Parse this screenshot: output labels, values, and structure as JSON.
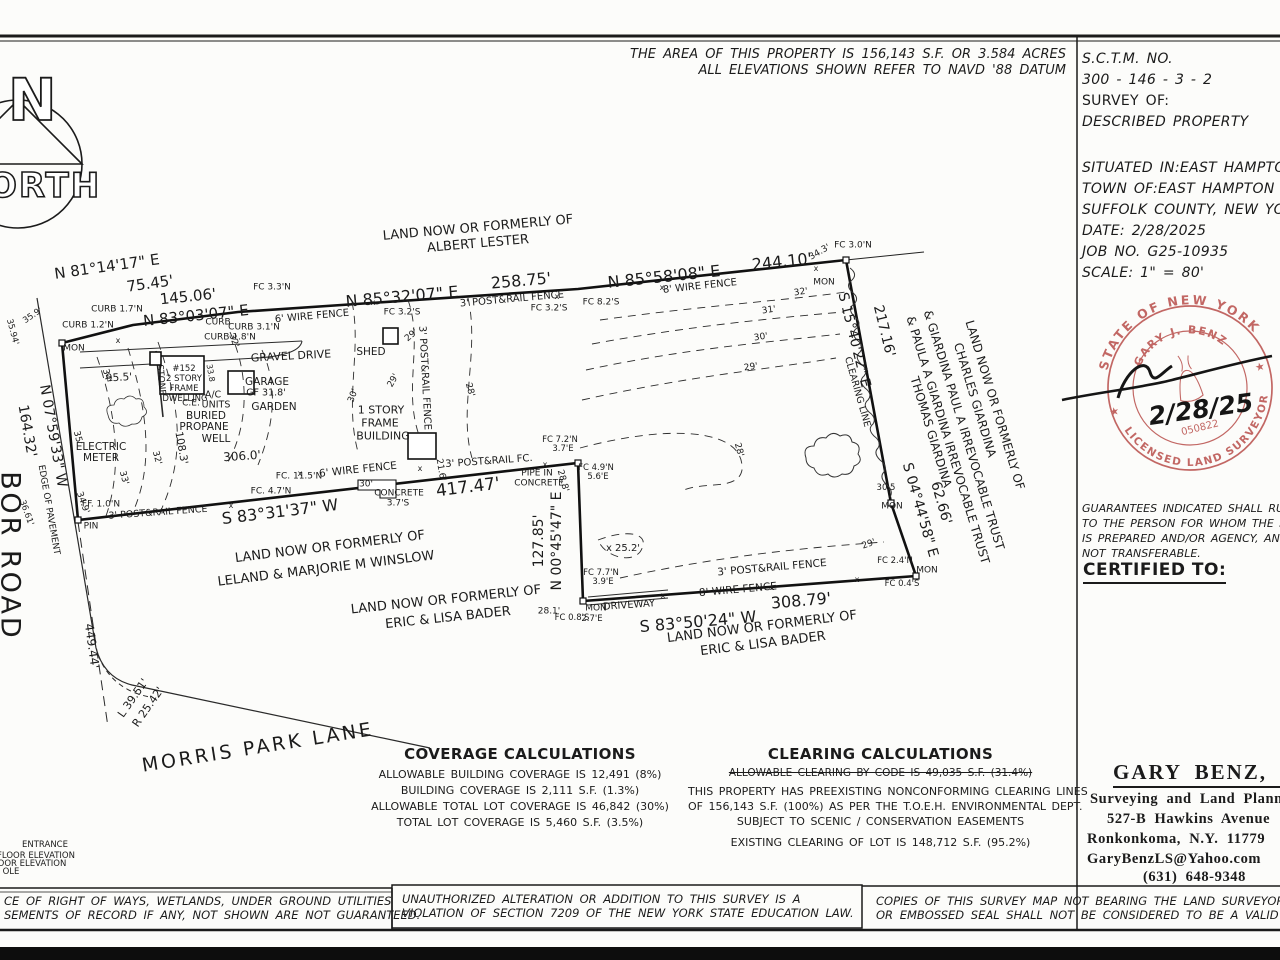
{
  "notes_top": [
    "THE AREA OF THIS PROPERTY IS 156,143 S.F. OR 3.584 ACRES",
    "ALL ELEVATIONS SHOWN REFER TO NAVD '88 DATUM"
  ],
  "north": {
    "n": "N",
    "orth": "ORTH"
  },
  "title_block": {
    "sctm_label": "S.C.T.M. NO.",
    "sctm_value": "300   -   146   -   3   -   2",
    "survey_of_label": "SURVEY OF:",
    "survey_of_value": "DESCRIBED PROPERTY",
    "situated_in": "SITUATED IN:EAST HAMPTON",
    "town_of": "TOWN OF:EAST HAMPTON",
    "county": "SUFFOLK COUNTY, NEW YORK",
    "date": "DATE: 2/28/2025",
    "job_no": "JOB NO. G25-10935",
    "scale": "SCALE: 1\" = 80'"
  },
  "stamp": {
    "arc_top": "STATE OF NEW YORK",
    "name": "GARY J. BENZ",
    "arc_bottom": "LICENSED LAND SURVEYOR",
    "license_no": "050822",
    "date_signed": "2/28/25",
    "color": "#b84e4a"
  },
  "guarantees": [
    "GUARANTEES INDICATED SHALL RUN ONLY",
    "TO THE PERSON FOR WHOM THE SURVEY",
    "IS PREPARED AND/OR AGENCY, AND IS",
    "NOT TRANSFERABLE."
  ],
  "certified_to": "CERTIFIED TO:",
  "surveyor": {
    "name": "GARY BENZ, L.S.",
    "line1": "Surveying and Land Planning",
    "line2": "527-B Hawkins Avenue",
    "line3": "Ronkonkoma, N.Y. 11779",
    "line4": "GaryBenzLS@Yahoo.com",
    "line5": "(631) 648-9348"
  },
  "coverage": {
    "title": "COVERAGE CALCULATIONS",
    "lines": [
      "ALLOWABLE BUILDING COVERAGE IS 12,491 (8%)",
      "BUILDING COVERAGE IS 2,111 S.F. (1.3%)",
      "ALLOWABLE TOTAL LOT COVERAGE IS 46,842 (30%)",
      "TOTAL LOT COVERAGE IS 5,460 S.F. (3.5%)"
    ]
  },
  "clearing": {
    "title": "CLEARING CALCULATIONS",
    "struck": "ALLOWABLE CLEARING BY CODE IS 49,035 S.F. (31.4%)",
    "lines": [
      "THIS PROPERTY HAS PREEXISTING NONCONFORMING CLEARING LINES",
      "OF 156,143 S.F. (100%) AS PER THE T.O.E.H. ENVIRONMENTAL DEPT.",
      "SUBJECT TO SCENIC / CONSERVATION EASEMENTS"
    ],
    "existing": "EXISTING CLEARING OF LOT IS 148,712 S.F. (95.2%)"
  },
  "boxes": {
    "left": [
      "CE OF RIGHT OF WAYS, WETLANDS, UNDER GROUND UTILITIES",
      "SEMENTS OF RECORD IF ANY, NOT SHOWN ARE NOT GUARANTEED."
    ],
    "middle": [
      "UNAUTHORIZED ALTERATION OR ADDITION TO THIS SURVEY IS A",
      "VIOLATION OF SECTION 7209 OF THE NEW YORK STATE EDUCATION LAW."
    ],
    "right": [
      "COPIES OF THIS SURVEY MAP NOT BEARING THE LAND SURVEYOR'S INKED SEAL",
      "OR EMBOSSED SEAL SHALL NOT BE CONSIDERED TO BE A VALID TRUE COPY."
    ]
  },
  "map_labels": [
    {
      "t": "N 81°14'17\" E",
      "x": 107,
      "y": 267,
      "r": -8,
      "s": 15
    },
    {
      "t": "75.45'",
      "x": 150,
      "y": 284,
      "r": -8,
      "s": 15
    },
    {
      "t": "145.06'",
      "x": 188,
      "y": 297,
      "r": -6,
      "s": 15
    },
    {
      "t": "N 83°03'07\" E",
      "x": 196,
      "y": 316,
      "r": -6,
      "s": 15
    },
    {
      "t": "N 85°32'07\" E",
      "x": 402,
      "y": 297,
      "r": -5,
      "s": 16
    },
    {
      "t": "258.75'",
      "x": 521,
      "y": 281,
      "r": -5,
      "s": 16
    },
    {
      "t": "N 85°58'08\" E",
      "x": 664,
      "y": 277,
      "r": -6,
      "s": 16
    },
    {
      "t": "244.10'",
      "x": 782,
      "y": 262,
      "r": -6,
      "s": 16
    },
    {
      "t": "S 15°40'22\" E",
      "x": 854,
      "y": 340,
      "r": 76,
      "s": 14
    },
    {
      "t": "217.16'",
      "x": 884,
      "y": 331,
      "r": 76,
      "s": 14
    },
    {
      "t": "S 04°44'58\" E",
      "x": 920,
      "y": 510,
      "r": 74,
      "s": 14
    },
    {
      "t": "62.66'",
      "x": 941,
      "y": 503,
      "r": 74,
      "s": 14
    },
    {
      "t": "S 83°31'37\" W",
      "x": 280,
      "y": 512,
      "r": -7,
      "s": 16
    },
    {
      "t": "417.47'",
      "x": 468,
      "y": 488,
      "r": -7,
      "s": 17
    },
    {
      "t": "N 00°45'47\" E",
      "x": 557,
      "y": 541,
      "r": -90,
      "s": 14
    },
    {
      "t": "127.85'",
      "x": 539,
      "y": 541,
      "r": -90,
      "s": 14
    },
    {
      "t": "S 83°50'24\" W",
      "x": 698,
      "y": 622,
      "r": -5,
      "s": 16
    },
    {
      "t": "308.79'",
      "x": 801,
      "y": 601,
      "r": -5,
      "s": 16
    },
    {
      "t": "N 07°59'33\" W",
      "x": 53,
      "y": 436,
      "r": 80,
      "s": 14
    },
    {
      "t": "164.32'",
      "x": 27,
      "y": 431,
      "r": 80,
      "s": 14
    },
    {
      "t": "449.44'",
      "x": 92,
      "y": 646,
      "r": 82,
      "s": 12
    },
    {
      "t": "L 39.51'",
      "x": 133,
      "y": 698,
      "r": -55,
      "s": 11
    },
    {
      "t": "R 25.42'",
      "x": 148,
      "y": 707,
      "r": -55,
      "s": 11
    },
    {
      "t": "LAND NOW OR FORMERLY OF",
      "x": 478,
      "y": 228,
      "r": -5,
      "s": 13
    },
    {
      "t": "ALBERT LESTER",
      "x": 478,
      "y": 244,
      "r": -5,
      "s": 13
    },
    {
      "t": "LAND NOW OR FORMERLY OF",
      "x": 330,
      "y": 547,
      "r": -7,
      "s": 13
    },
    {
      "t": "LELAND & MARJORIE M WINSLOW",
      "x": 326,
      "y": 569,
      "r": -7,
      "s": 13
    },
    {
      "t": "LAND NOW OR FORMERLY OF",
      "x": 446,
      "y": 600,
      "r": -6,
      "s": 13
    },
    {
      "t": "ERIC & LISA BADER",
      "x": 448,
      "y": 618,
      "r": -6,
      "s": 13
    },
    {
      "t": "LAND NOW OR FORMERLY OF",
      "x": 762,
      "y": 627,
      "r": -7,
      "s": 13
    },
    {
      "t": "ERIC & LISA BADER",
      "x": 763,
      "y": 644,
      "r": -7,
      "s": 13
    },
    {
      "t": "LAND NOW OR FORMERLY OF",
      "x": 995,
      "y": 405,
      "r": 73,
      "s": 12
    },
    {
      "t": "CHARLES GIARDINA",
      "x": 975,
      "y": 400,
      "r": 73,
      "s": 12
    },
    {
      "t": "& GIARDINA PAUL A IRREVOCABLE TRUST",
      "x": 964,
      "y": 430,
      "r": 73,
      "s": 12
    },
    {
      "t": "& PAULA A GIARDINA IRREVOCABLE TRUST",
      "x": 948,
      "y": 440,
      "r": 73,
      "s": 12
    },
    {
      "t": "THOMAS GIARDINA",
      "x": 931,
      "y": 432,
      "r": 73,
      "s": 12
    },
    {
      "t": "BOR ROAD",
      "x": 10,
      "y": 556,
      "r": 90,
      "s": 27,
      "ls": 3,
      "n": "road-name-harbor-road"
    },
    {
      "t": "MORRIS PARK LANE",
      "x": 258,
      "y": 748,
      "r": -9,
      "s": 19,
      "ls": 3,
      "n": "road-name-morris-park-lane"
    },
    {
      "t": "EDGE OF PAVEMENT",
      "x": 48,
      "y": 510,
      "r": 80,
      "s": 9
    },
    {
      "t": "GRAVEL DRIVE",
      "x": 291,
      "y": 356,
      "r": -3,
      "s": 11
    },
    {
      "t": "MON",
      "x": 74,
      "y": 349,
      "r": 0,
      "s": 9
    },
    {
      "t": "CURB 1.2'N",
      "x": 88,
      "y": 326,
      "r": 0,
      "s": 9
    },
    {
      "t": "CURB 1.7'N",
      "x": 117,
      "y": 310,
      "r": 0,
      "s": 9
    },
    {
      "t": "CURB",
      "x": 218,
      "y": 323,
      "r": 0,
      "s": 9
    },
    {
      "t": "CURB 1.8'N",
      "x": 230,
      "y": 338,
      "r": 0,
      "s": 9
    },
    {
      "t": "CURB 3.1'N",
      "x": 254,
      "y": 328,
      "r": 0,
      "s": 9
    },
    {
      "t": "FC 3.3'N",
      "x": 272,
      "y": 288,
      "r": 0,
      "s": 9
    },
    {
      "t": "6' WIRE FENCE",
      "x": 312,
      "y": 317,
      "r": -5,
      "s": 10
    },
    {
      "t": "3' POST&RAIL FENCE",
      "x": 512,
      "y": 300,
      "r": -5,
      "s": 10
    },
    {
      "t": "FC 3.2'S",
      "x": 402,
      "y": 313,
      "r": 0,
      "s": 9
    },
    {
      "t": "FC 3.2'S",
      "x": 549,
      "y": 309,
      "r": 0,
      "s": 9
    },
    {
      "t": "FC 8.2'S",
      "x": 601,
      "y": 303,
      "r": 0,
      "s": 9
    },
    {
      "t": "8' WIRE FENCE",
      "x": 700,
      "y": 287,
      "r": -6,
      "s": 10
    },
    {
      "t": "34.3'",
      "x": 820,
      "y": 253,
      "r": -30,
      "s": 9
    },
    {
      "t": "FC 3.0'N",
      "x": 853,
      "y": 246,
      "r": 0,
      "s": 9
    },
    {
      "t": "MON",
      "x": 824,
      "y": 283,
      "r": 0,
      "s": 9
    },
    {
      "t": "SHED",
      "x": 371,
      "y": 352,
      "r": 0,
      "s": 10.5
    },
    {
      "t": "3' POST&RAIL FENCE",
      "x": 424,
      "y": 378,
      "r": 87,
      "s": 10
    },
    {
      "t": "1 STORY",
      "x": 381,
      "y": 410,
      "r": 0,
      "s": 11
    },
    {
      "t": "FRAME",
      "x": 380,
      "y": 423,
      "r": 0,
      "s": 11
    },
    {
      "t": "BUILDING",
      "x": 383,
      "y": 436,
      "r": 0,
      "s": 11
    },
    {
      "t": "#152",
      "x": 184,
      "y": 369,
      "r": 0,
      "s": 8.5
    },
    {
      "t": "2 STORY",
      "x": 184,
      "y": 379,
      "r": 0,
      "s": 8.5
    },
    {
      "t": "FRAME",
      "x": 184,
      "y": 389,
      "r": 0,
      "s": 8.5
    },
    {
      "t": "DWELLING",
      "x": 185,
      "y": 399,
      "r": 0,
      "s": 8.5
    },
    {
      "t": "STONE",
      "x": 160,
      "y": 380,
      "r": 85,
      "s": 9
    },
    {
      "t": "GARAGE",
      "x": 267,
      "y": 382,
      "r": 0,
      "s": 10.5
    },
    {
      "t": "GF 31.8'",
      "x": 266,
      "y": 393,
      "r": 0,
      "s": 9.5
    },
    {
      "t": "A/C",
      "x": 213,
      "y": 395,
      "r": 0,
      "s": 9.5
    },
    {
      "t": "UNITS",
      "x": 216,
      "y": 405,
      "r": 0,
      "s": 9.5
    },
    {
      "t": "C.E.",
      "x": 191,
      "y": 404,
      "r": 0,
      "s": 9
    },
    {
      "t": "GARDEN",
      "x": 274,
      "y": 407,
      "r": 0,
      "s": 10.5
    },
    {
      "t": "BURIED",
      "x": 206,
      "y": 416,
      "r": 0,
      "s": 10.5
    },
    {
      "t": "PROPANE",
      "x": 204,
      "y": 427,
      "r": 0,
      "s": 10.5
    },
    {
      "t": "WELL",
      "x": 216,
      "y": 439,
      "r": 0,
      "s": 10.5
    },
    {
      "t": "ELECTRIC",
      "x": 101,
      "y": 447,
      "r": 0,
      "s": 10.5
    },
    {
      "t": "METER",
      "x": 101,
      "y": 458,
      "r": 0,
      "s": 10.5
    },
    {
      "t": "95.5'",
      "x": 119,
      "y": 378,
      "r": -3,
      "s": 10.5
    },
    {
      "t": "108.3'",
      "x": 181,
      "y": 448,
      "r": 80,
      "s": 10.5
    },
    {
      "t": "306.0'",
      "x": 242,
      "y": 456,
      "r": -4,
      "s": 12
    },
    {
      "t": "6' WIRE FENCE",
      "x": 358,
      "y": 470,
      "r": -6,
      "s": 10.5
    },
    {
      "t": "FC. 11.5'N",
      "x": 299,
      "y": 477,
      "r": 0,
      "s": 9
    },
    {
      "t": "FC. 4.7'N",
      "x": 271,
      "y": 492,
      "r": 0,
      "s": 9
    },
    {
      "t": "3' POST&RAIL FC.",
      "x": 489,
      "y": 462,
      "r": -4,
      "s": 10
    },
    {
      "t": "FC 7.2'N",
      "x": 560,
      "y": 440,
      "r": 0,
      "s": 8.5
    },
    {
      "t": "3.7'E",
      "x": 563,
      "y": 449,
      "r": 0,
      "s": 8.5
    },
    {
      "t": "PIPE IN",
      "x": 537,
      "y": 474,
      "r": 0,
      "s": 9
    },
    {
      "t": "CONCRETE",
      "x": 539,
      "y": 484,
      "r": 0,
      "s": 9
    },
    {
      "t": "28.8'",
      "x": 562,
      "y": 481,
      "r": 75,
      "s": 9
    },
    {
      "t": "FC 4.9'N",
      "x": 596,
      "y": 468,
      "r": 0,
      "s": 8.5
    },
    {
      "t": "5.6'E",
      "x": 598,
      "y": 477,
      "r": 0,
      "s": 8.5
    },
    {
      "t": "CONCRETE",
      "x": 399,
      "y": 494,
      "r": 0,
      "s": 9
    },
    {
      "t": "3.7'S",
      "x": 398,
      "y": 504,
      "r": 0,
      "s": 9
    },
    {
      "t": "3' POST&RAIL FENCE",
      "x": 158,
      "y": 513,
      "r": -4,
      "s": 9.5
    },
    {
      "t": "PIN",
      "x": 91,
      "y": 527,
      "r": 0,
      "s": 9
    },
    {
      "t": "34.9'",
      "x": 82,
      "y": 503,
      "r": 70,
      "s": 9
    },
    {
      "t": "36.61'",
      "x": 26,
      "y": 513,
      "r": 70,
      "s": 8.5
    },
    {
      "t": "FF. 1.0'N",
      "x": 101,
      "y": 505,
      "r": 0,
      "s": 9
    },
    {
      "t": "x 25.2'",
      "x": 623,
      "y": 549,
      "r": 0,
      "s": 10
    },
    {
      "t": "DRIVEWAY",
      "x": 629,
      "y": 606,
      "r": -4,
      "s": 10
    },
    {
      "t": "8' WIRE FENCE",
      "x": 738,
      "y": 590,
      "r": -5,
      "s": 10.5
    },
    {
      "t": "3' POST&RAIL FENCE",
      "x": 772,
      "y": 568,
      "r": -5,
      "s": 10.5
    },
    {
      "t": "FC 7.7'N",
      "x": 601,
      "y": 573,
      "r": 0,
      "s": 8.5
    },
    {
      "t": "3.9'E",
      "x": 603,
      "y": 582,
      "r": 0,
      "s": 8.5
    },
    {
      "t": "28.1'",
      "x": 549,
      "y": 612,
      "r": 0,
      "s": 9
    },
    {
      "t": "FC 0.8'S",
      "x": 572,
      "y": 618,
      "r": 0,
      "s": 8.5
    },
    {
      "t": "MON",
      "x": 596,
      "y": 609,
      "r": 0,
      "s": 9
    },
    {
      "t": "2.7'E",
      "x": 592,
      "y": 619,
      "r": 0,
      "s": 8.5
    },
    {
      "t": "FC 2.4'N",
      "x": 895,
      "y": 561,
      "r": 0,
      "s": 8.5
    },
    {
      "t": "MON",
      "x": 927,
      "y": 571,
      "r": 0,
      "s": 9
    },
    {
      "t": "FC 0.4'S",
      "x": 902,
      "y": 584,
      "r": 0,
      "s": 8.5
    },
    {
      "t": "30.5",
      "x": 886,
      "y": 488,
      "r": 0,
      "s": 8.5
    },
    {
      "t": "MON",
      "x": 892,
      "y": 507,
      "r": 0,
      "s": 9
    },
    {
      "t": "CLEARING LINE",
      "x": 857,
      "y": 392,
      "r": 74,
      "s": 9.5
    },
    {
      "t": "35'",
      "x": 77,
      "y": 438,
      "r": 75,
      "s": 9
    },
    {
      "t": "34'",
      "x": 106,
      "y": 376,
      "r": 75,
      "s": 9
    },
    {
      "t": "33'",
      "x": 123,
      "y": 478,
      "r": 75,
      "s": 9
    },
    {
      "t": "32'",
      "x": 156,
      "y": 458,
      "r": 75,
      "s": 9
    },
    {
      "t": "32'",
      "x": 233,
      "y": 341,
      "r": 70,
      "s": 9
    },
    {
      "t": "30'",
      "x": 354,
      "y": 396,
      "r": -70,
      "s": 9
    },
    {
      "t": "29'",
      "x": 412,
      "y": 336,
      "r": -40,
      "s": 9
    },
    {
      "t": "29'",
      "x": 394,
      "y": 381,
      "r": -60,
      "s": 9
    },
    {
      "t": "28'",
      "x": 469,
      "y": 390,
      "r": 75,
      "s": 9
    },
    {
      "t": "32'",
      "x": 801,
      "y": 293,
      "r": -8,
      "s": 9
    },
    {
      "t": "31'",
      "x": 769,
      "y": 311,
      "r": -8,
      "s": 9
    },
    {
      "t": "30'",
      "x": 761,
      "y": 338,
      "r": -8,
      "s": 9
    },
    {
      "t": "29'",
      "x": 751,
      "y": 368,
      "r": -8,
      "s": 9
    },
    {
      "t": "28'",
      "x": 738,
      "y": 450,
      "r": 75,
      "s": 9
    },
    {
      "t": "29'",
      "x": 869,
      "y": 545,
      "r": -20,
      "s": 9
    },
    {
      "t": "30'",
      "x": 366,
      "y": 485,
      "r": 0,
      "s": 9
    },
    {
      "t": "21.6'",
      "x": 440,
      "y": 470,
      "r": 80,
      "s": 9
    },
    {
      "t": "33.8",
      "x": 210,
      "y": 373,
      "r": 80,
      "s": 8
    },
    {
      "t": "35.94'",
      "x": 12,
      "y": 332,
      "r": 75,
      "s": 8.5
    },
    {
      "t": "35.9'",
      "x": 33,
      "y": 316,
      "r": -35,
      "s": 8.5
    },
    {
      "t": "x",
      "x": 373,
      "y": 303,
      "r": 0,
      "s": 8
    },
    {
      "t": "x",
      "x": 557,
      "y": 297,
      "r": 0,
      "s": 8
    },
    {
      "t": "x",
      "x": 662,
      "y": 288,
      "r": 0,
      "s": 8
    },
    {
      "t": "x",
      "x": 816,
      "y": 269,
      "r": 0,
      "s": 8
    },
    {
      "t": "x",
      "x": 300,
      "y": 474,
      "r": 0,
      "s": 8
    },
    {
      "t": "x",
      "x": 420,
      "y": 469,
      "r": 0,
      "s": 8
    },
    {
      "t": "x",
      "x": 545,
      "y": 465,
      "r": 0,
      "s": 8
    },
    {
      "t": "x",
      "x": 663,
      "y": 596,
      "r": 0,
      "s": 8
    },
    {
      "t": "x",
      "x": 772,
      "y": 588,
      "r": 0,
      "s": 8
    },
    {
      "t": "x",
      "x": 857,
      "y": 580,
      "r": 0,
      "s": 8
    },
    {
      "t": "x",
      "x": 231,
      "y": 506,
      "r": 0,
      "s": 8
    },
    {
      "t": "x",
      "x": 118,
      "y": 341,
      "r": 0,
      "s": 8
    },
    {
      "t": "ENTRANCE",
      "x": 45,
      "y": 845,
      "r": 0,
      "s": 8.5,
      "n": "legend-fragment"
    },
    {
      "t": "FLOOR ELEVATION",
      "x": 36,
      "y": 856,
      "r": 0,
      "s": 8.5,
      "n": "legend-fragment"
    },
    {
      "t": "OOR ELEVATION",
      "x": 32,
      "y": 864,
      "r": 0,
      "s": 8.5,
      "n": "legend-fragment"
    },
    {
      "t": "OLE",
      "x": 11,
      "y": 872,
      "r": 0,
      "s": 8.5,
      "n": "legend-fragment"
    }
  ]
}
